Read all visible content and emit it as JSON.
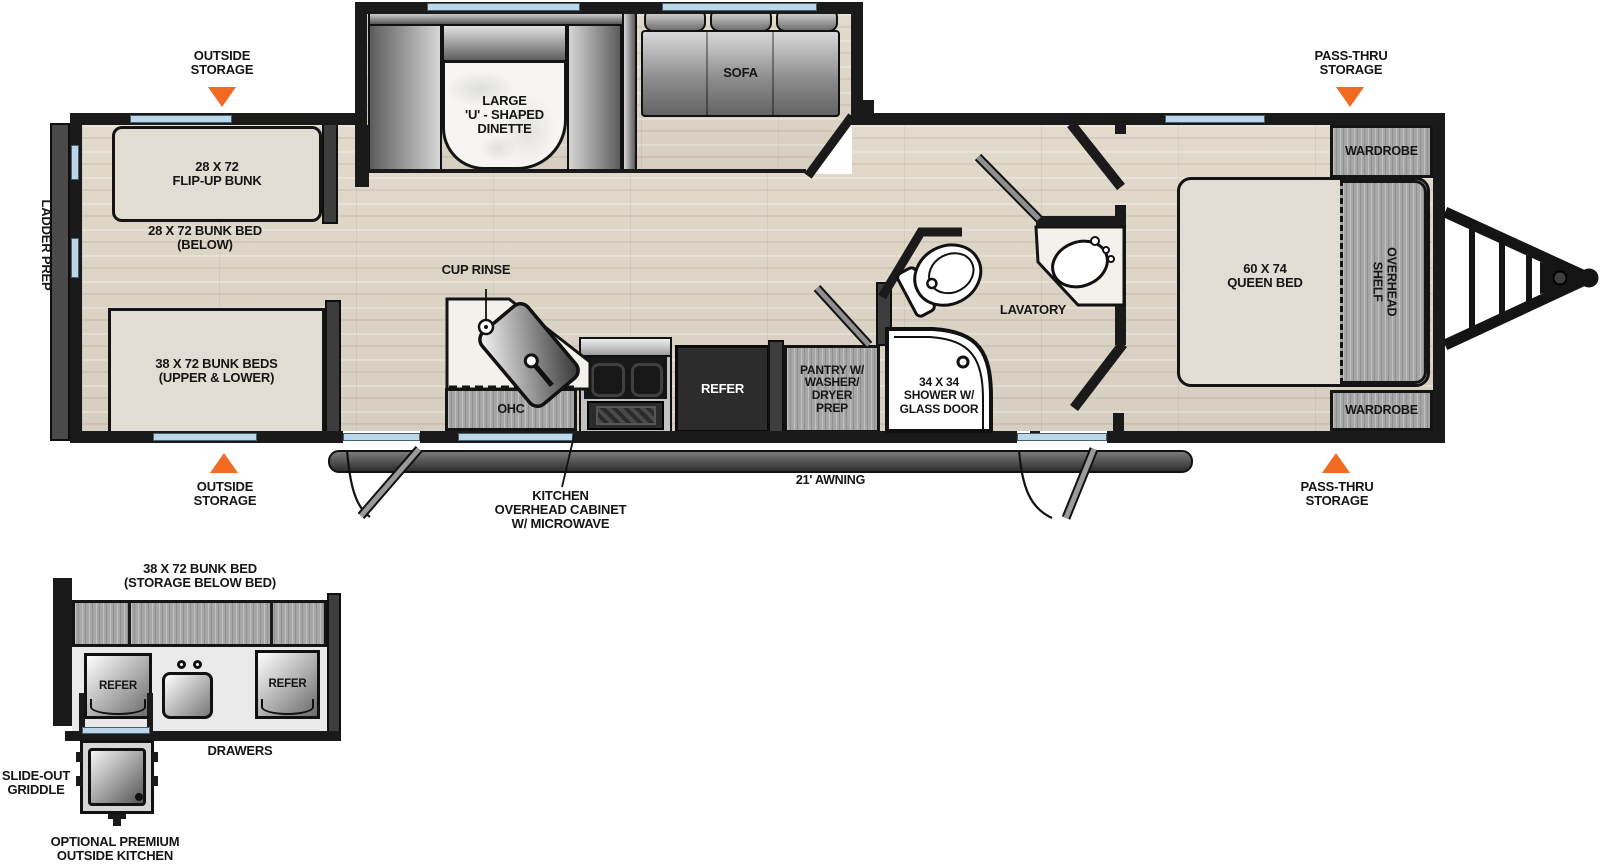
{
  "colors": {
    "accent_orange": "#f26a21",
    "window_blue": "#bcd6ea",
    "wall": "#1a1a1a",
    "floor_base": "#ddd5c6"
  },
  "exterior": {
    "ladder_prep": "LADDER PREP",
    "awning": "21' AWNING",
    "outside_storage_top": "OUTSIDE\nSTORAGE",
    "outside_storage_bottom": "OUTSIDE\nSTORAGE",
    "pass_thru_top": "PASS-THRU\nSTORAGE",
    "pass_thru_bottom": "PASS-THRU\nSTORAGE"
  },
  "bunk_area": {
    "flip_up_bunk": "28 X 72\nFLIP-UP BUNK",
    "bunk_below": "28 X 72 BUNK BED\n(BELOW)",
    "bunks_upper_lower": "38 X 72 BUNK BEDS\n(UPPER & LOWER)"
  },
  "living_area": {
    "dinette": "LARGE\n'U' - SHAPED\nDINETTE",
    "sofa": "SOFA"
  },
  "kitchen": {
    "cup_rinse": "CUP RINSE",
    "ohc": "OHC",
    "refer": "REFER",
    "overhead_cabinet": "KITCHEN\nOVERHEAD CABINET\nW/ MICROWAVE",
    "pantry": "PANTRY W/\nWASHER/\nDRYER\nPREP"
  },
  "bathroom": {
    "shower": "34 X 34\nSHOWER W/\nGLASS DOOR",
    "lavatory": "LAVATORY"
  },
  "bedroom": {
    "queen_bed": "60 X 74\nQUEEN BED",
    "overhead_shelf": "OVERHEAD\nSHELF",
    "wardrobe_rear": "WARDROBE",
    "wardrobe_front": "WARDROBE"
  },
  "outside_kitchen": {
    "title": "38 X 72 BUNK BED\n(STORAGE BELOW BED)",
    "refer_left": "REFER",
    "refer_right": "REFER",
    "drawers": "DRAWERS",
    "slide_out_griddle": "SLIDE-OUT\nGRIDDLE",
    "caption": "OPTIONAL PREMIUM\nOUTSIDE KITCHEN"
  }
}
